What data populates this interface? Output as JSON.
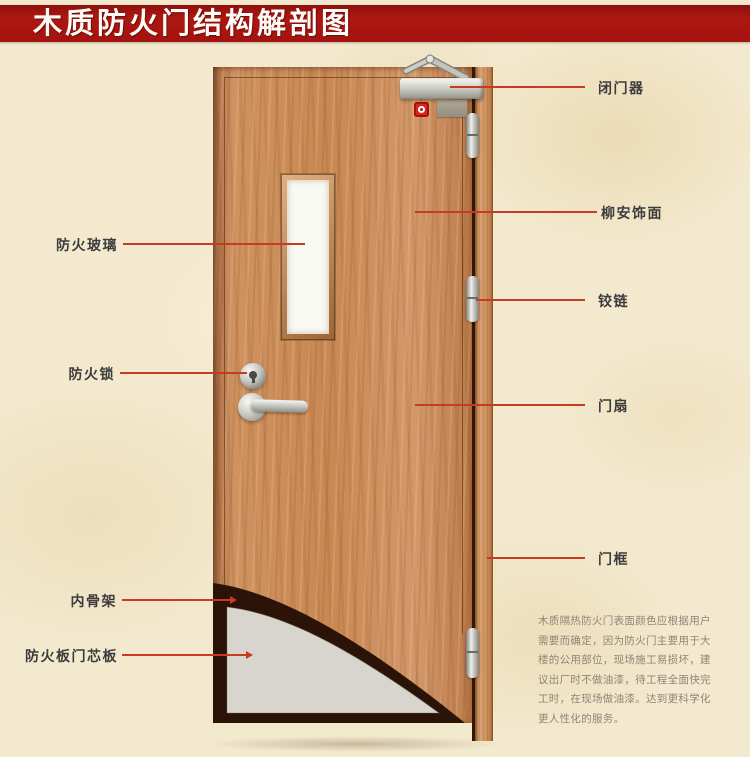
{
  "title": "木质防火门结构解剖图",
  "callouts": {
    "left": [
      {
        "id": "fire-glass",
        "label": "防火玻璃"
      },
      {
        "id": "fire-lock",
        "label": "防火锁"
      },
      {
        "id": "inner-skeleton",
        "label": "内骨架"
      },
      {
        "id": "fire-board-core",
        "label": "防火板门芯板"
      }
    ],
    "right": [
      {
        "id": "door-closer",
        "label": "闭门器"
      },
      {
        "id": "lauan-veneer",
        "label": "柳安饰面"
      },
      {
        "id": "hinge",
        "label": "铰链"
      },
      {
        "id": "door-leaf",
        "label": "门扇"
      },
      {
        "id": "door-frame",
        "label": "门框"
      }
    ]
  },
  "description": {
    "lines": [
      "木质隔热防火门表面颜色应根据用户",
      "需要而确定，因为防火门主要用于大",
      "楼的公用部位，现场施工易损坏，建",
      "议出厂时不做油漆，待工程全面快完",
      "工时，在现场做油漆。达到更科学化",
      "更人性化的服务。"
    ]
  },
  "colors": {
    "banner_red": "#a41310",
    "callout_line_red": "#c63b22",
    "parchment": "#f3e9ce",
    "wood": "#c98853",
    "core_panel": "#d7d5cd",
    "skeleton_dark": "#2b1407"
  }
}
